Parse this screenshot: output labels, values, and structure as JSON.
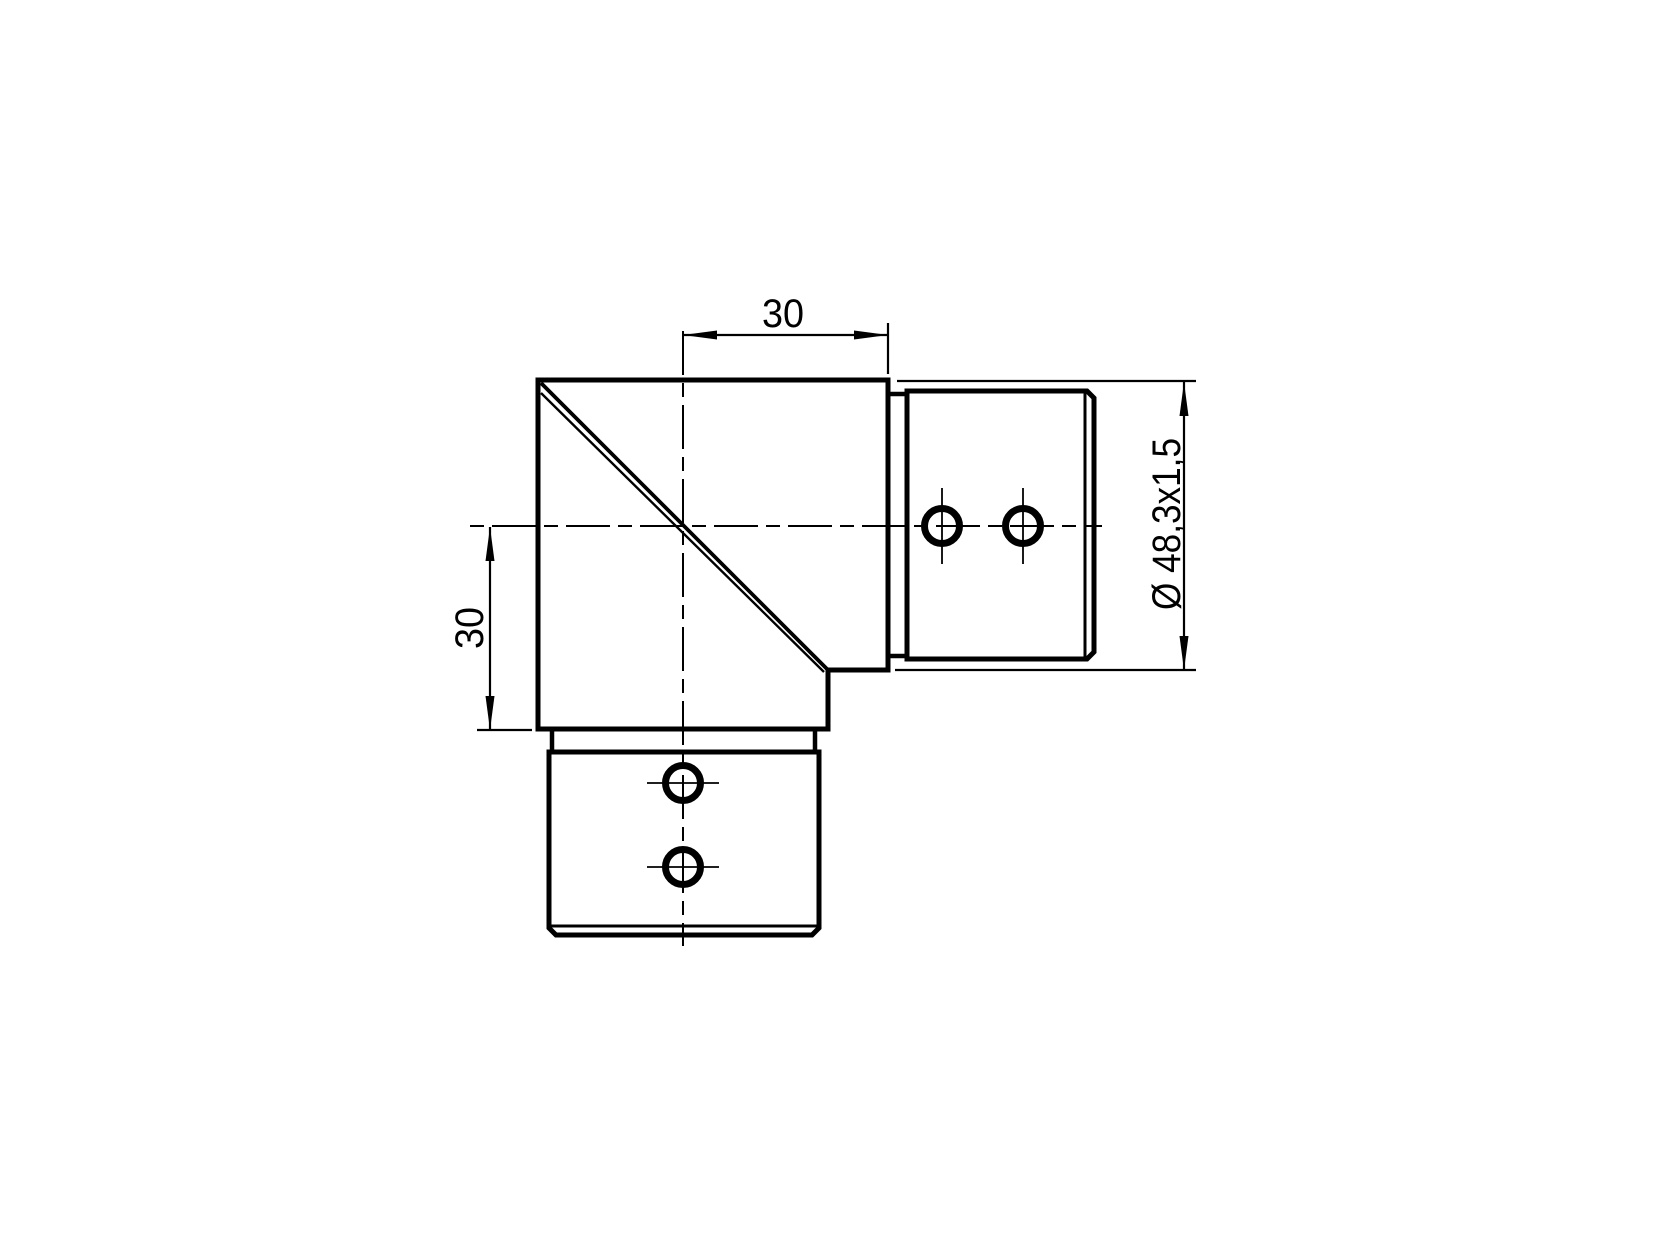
{
  "colors": {
    "background": "#ffffff",
    "line": "#000000"
  },
  "dimensions": {
    "top_width_mm": "30",
    "side_offset_mm": "30",
    "tube_spec": "Ø 48,3x1,5"
  }
}
